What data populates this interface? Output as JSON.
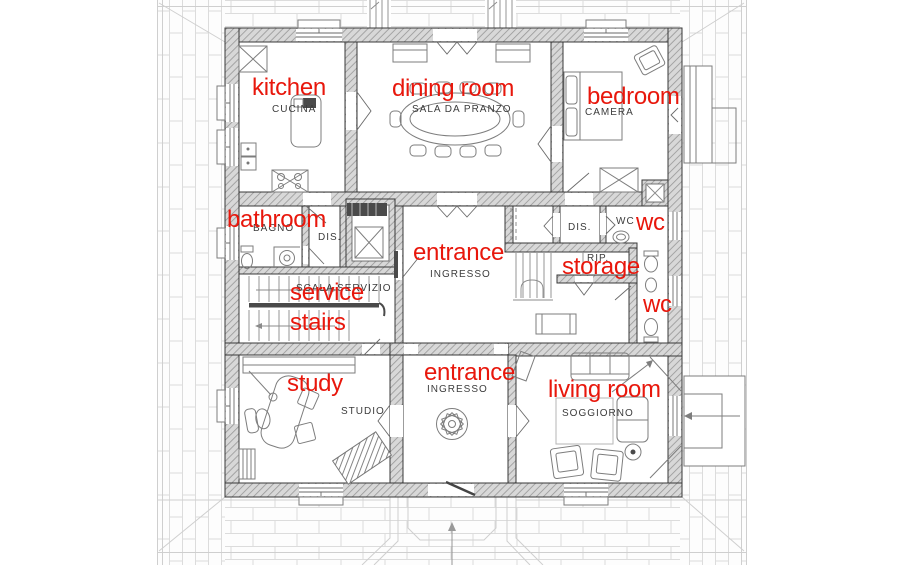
{
  "plan": {
    "annotations": {
      "kitchen": "kitchen",
      "dining_room": "dining room",
      "bedroom": "bedroom",
      "bathroom": "bathroom",
      "entrance_upper": "entrance",
      "wc_upper": "wc",
      "storage": "storage",
      "service": "service",
      "stairs": "stairs",
      "wc_lower": "wc",
      "study": "study",
      "entrance_lower": "entrance",
      "living_room": "living room"
    },
    "room_labels": {
      "kitchen": "CUCINA",
      "dining_room": "SALA DA PRANZO",
      "bedroom": "CAMERA",
      "bathroom": "BAGNO",
      "hall_left": "DIS.",
      "hall_right": "DIS.",
      "wc": "WC",
      "storage": "RIP.",
      "service_stairs": "SCALA SERVIZIO",
      "entrance_upper": "INGRESSO",
      "entrance_lower": "INGRESSO",
      "study": "STUDIO",
      "living_room": "SOGGIORNO"
    },
    "colors": {
      "annotation_red": "#e8170c",
      "label_gray": "#3c3c3c",
      "wall_outline": "#383838",
      "wall_fill": "#d8d8d8",
      "wall_hatch_line": "#979797",
      "paving_line": "#dcdcdc"
    }
  }
}
